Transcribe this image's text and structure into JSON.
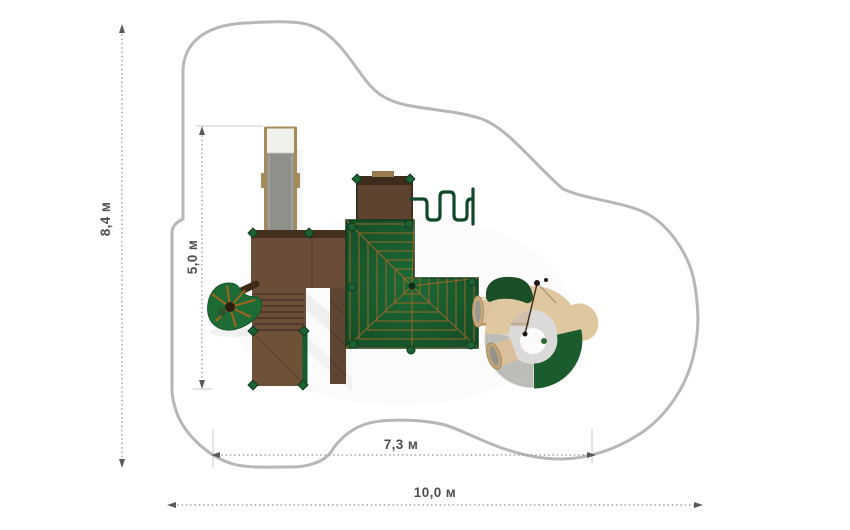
{
  "dimensions": {
    "site_height_label": "8,4 м",
    "equipment_height_label": "5,0 м",
    "equipment_width_label": "7,3 м",
    "site_width_label": "10,0 м"
  },
  "colors": {
    "safety_zone_outline": "#b7b7b7",
    "dimension_line": "#8f8f8f",
    "dimension_tick": "#c9c9c9",
    "dimension_text": "#4f4f4f",
    "roof_green": "#17552c",
    "roof_grid_orange": "#b06a28",
    "platform_brown": "#6a4c38",
    "stair_line_brown": "#4a3526",
    "slide_bed_gray": "#90908a",
    "slide_rail_tan": "#a58a5c",
    "tube_beige": "#dfc7a0",
    "spiral_gray": "#c2c0bc",
    "accent_green": "#1d6234",
    "leaf_green": "#1e6b35",
    "spoke_orange": "#a5641e",
    "background": "#ffffff"
  }
}
